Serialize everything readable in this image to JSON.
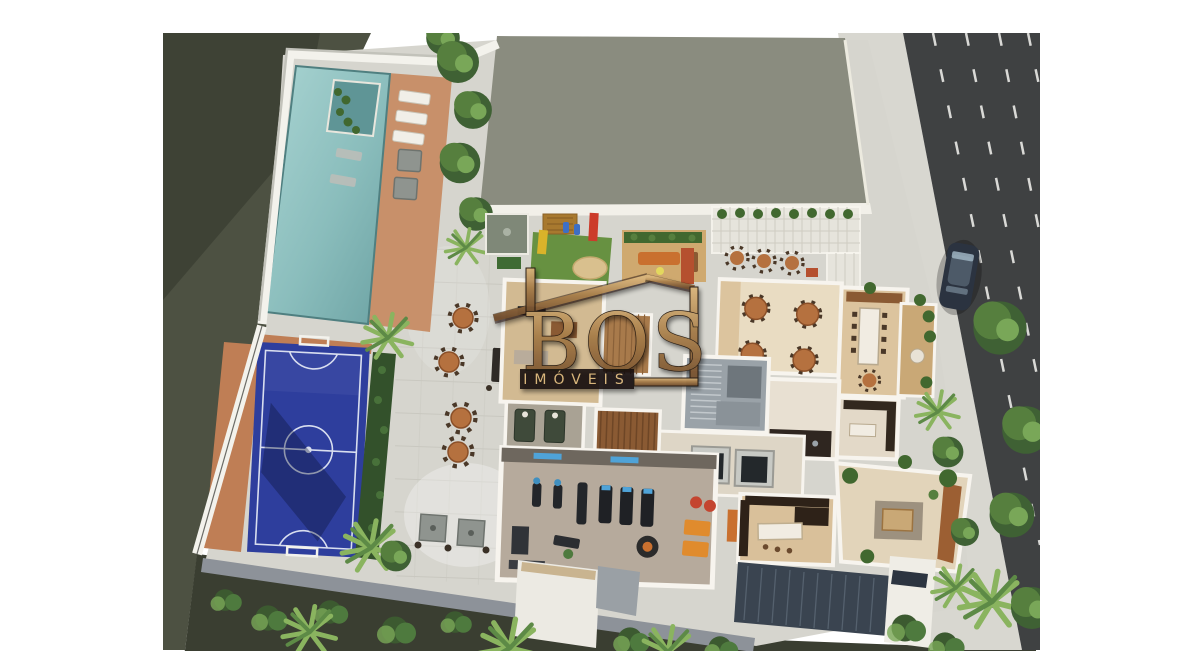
{
  "watermark": {
    "brand": "BOS",
    "subtitle": "IMÓVEIS"
  },
  "colors": {
    "background": "#ffffff",
    "lawn": "#4d5142",
    "lawn_shadow": "#3a3e31",
    "vegetation": "#3f6134",
    "street": "#3f4142",
    "street_marking": "#eaeae7",
    "sidewalk": "#d8d7d0",
    "terrace": "#d6d5ce",
    "paving_joint": "#c6c5bd",
    "roof": "#8a8c7f",
    "pool_water": "#93c4c2",
    "pool_deep": "#6ca2a3",
    "deck_wood": "#c8906a",
    "parapet": "#f3f2ec",
    "court_blue": "#2e3e9d",
    "court_line": "#e2e7f4",
    "court_surround": "#bf7e55",
    "hedge": "#33512b",
    "tree_mid": "#567f3e",
    "tree_light": "#79a758",
    "palm": "#8ab45f",
    "wall_white": "#f7f4ee",
    "floor_tan": "#dcc49e",
    "floor_cream": "#e9dcc2",
    "wood": "#a87a4b",
    "stair_gray": "#9aa2a8",
    "elevator_dark": "#23282b",
    "counter_dark": "#32281e",
    "gym_floor": "#b6aa9c",
    "gym_wall": "#6e675e",
    "tv_blue": "#4fa3d8",
    "mat_orange": "#e08b2d",
    "ball_red": "#c44530",
    "sofa_orange": "#c9702f",
    "green_wall": "#41682f",
    "sauna_wood": "#8a5a33",
    "skylight": "#3a4450",
    "car_body": "#2b3340",
    "bronze_light": "#d9b57c",
    "bronze": "#a57b48",
    "bronze_dark": "#6e4a2b",
    "outline_dark": "#241910",
    "band_dark": "#17110b"
  },
  "scene": {
    "areas": [
      "swimming-pool",
      "pool-deck",
      "futsal-court",
      "paved-terrace",
      "playground",
      "sandbox",
      "green-wall-lounge",
      "glass-pergola",
      "dining-room",
      "party-room",
      "balcony",
      "kitchen",
      "stairwell",
      "elevators",
      "sauna",
      "massage-room",
      "games-room",
      "gym",
      "wine-bar",
      "gourmet-lounge",
      "tower-roof",
      "sidewalk",
      "street",
      "parked-car",
      "lawn"
    ]
  }
}
